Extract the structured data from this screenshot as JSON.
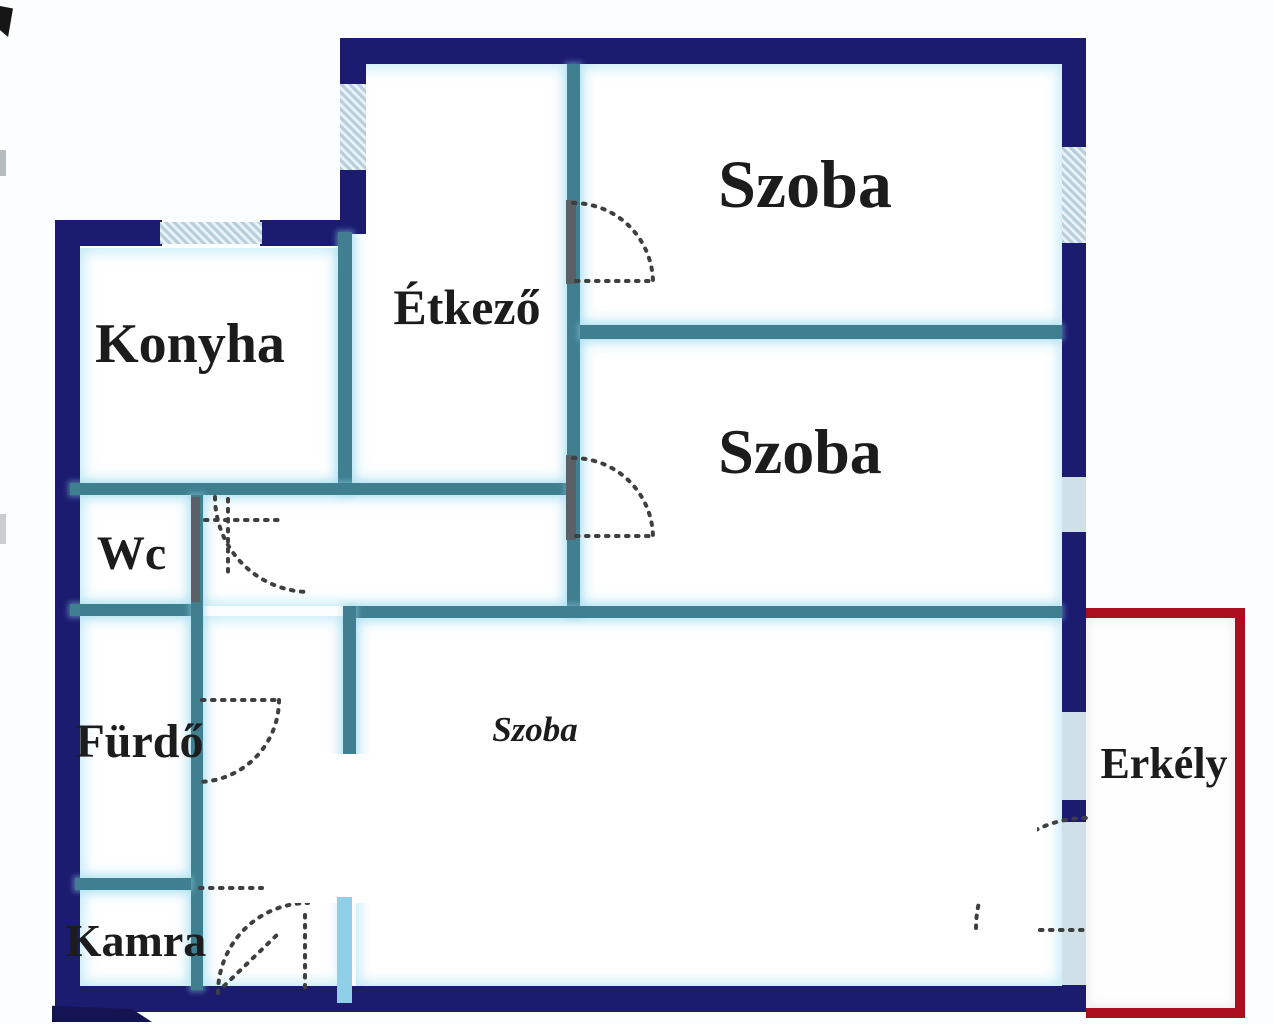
{
  "floorplan": {
    "type": "apartment-floor-plan",
    "language": "Hungarian",
    "rooms": [
      {
        "id": "konyha",
        "label": "Konyha"
      },
      {
        "id": "etkezo",
        "label": "Étkező"
      },
      {
        "id": "szoba-top",
        "label": "Szoba"
      },
      {
        "id": "szoba-middle",
        "label": "Szoba"
      },
      {
        "id": "szoba-bottom",
        "label": "Szoba"
      },
      {
        "id": "wc",
        "label": "Wc"
      },
      {
        "id": "furdo",
        "label": "Fürdő"
      },
      {
        "id": "kamra",
        "label": "Kamra"
      },
      {
        "id": "erkely",
        "label": "Erkély"
      }
    ],
    "palette": {
      "outer_wall": "#1b1b70",
      "inner_wall": "#3f7f90",
      "window_fill": "#cfe0e8",
      "window_hatch": "#b9cedb",
      "room_glow": "#96d8ee",
      "balcony_outline": "#ab0f1f",
      "door_swing_line": "#3f3f3f",
      "door_leaf": "#5a6065",
      "accent_bar": "#8fd0e8",
      "label_text": "#1c1c1c",
      "background": "#fcfdfe"
    }
  }
}
